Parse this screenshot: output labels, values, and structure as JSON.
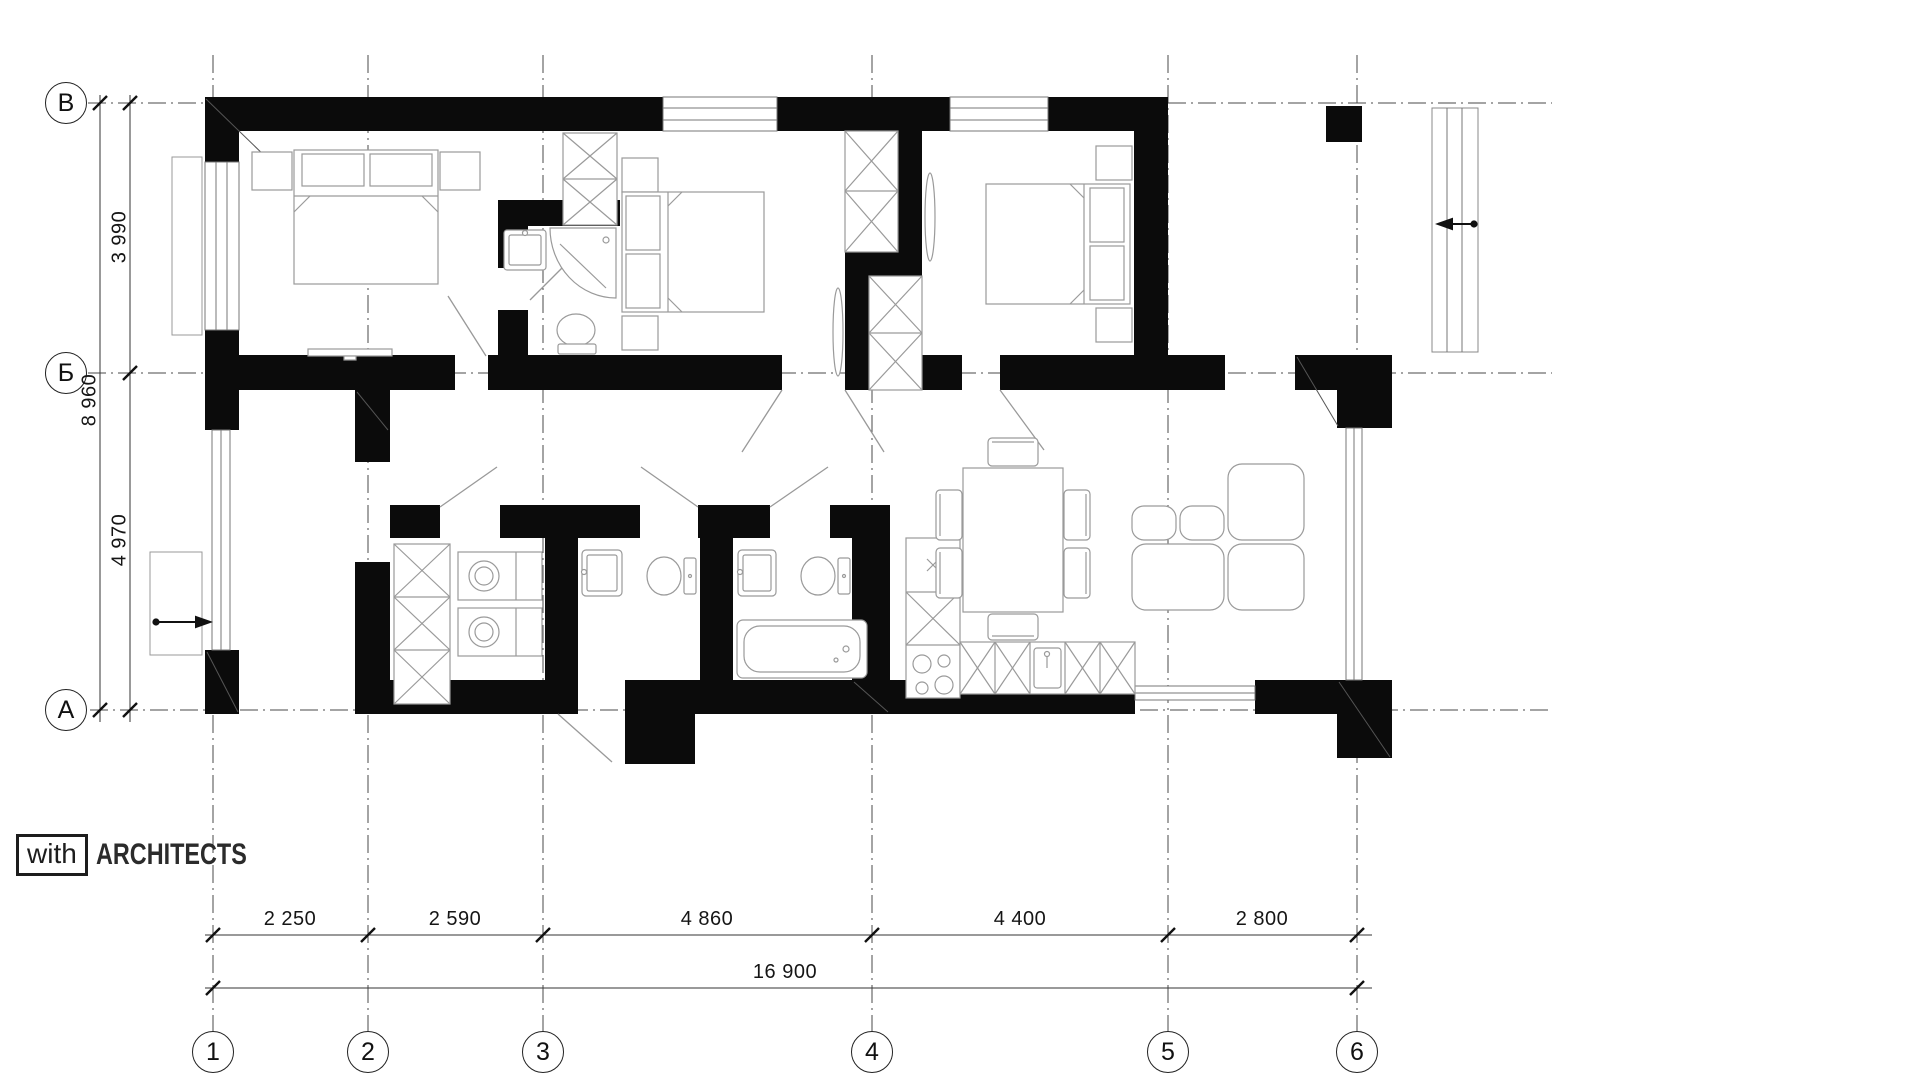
{
  "logo": {
    "box_text": "with",
    "brand_text": "ARCHITECTS"
  },
  "grid": {
    "row_labels": [
      "В",
      "Б",
      "А"
    ],
    "column_labels": [
      "1",
      "2",
      "3",
      "4",
      "5",
      "6"
    ]
  },
  "dimensions": {
    "left": {
      "segments": [
        "3 990",
        "4 970"
      ],
      "total": "8 960"
    },
    "bottom": {
      "segments": [
        "2 250",
        "2 590",
        "4 860",
        "4 400",
        "2 800"
      ],
      "total": "16 900"
    }
  }
}
